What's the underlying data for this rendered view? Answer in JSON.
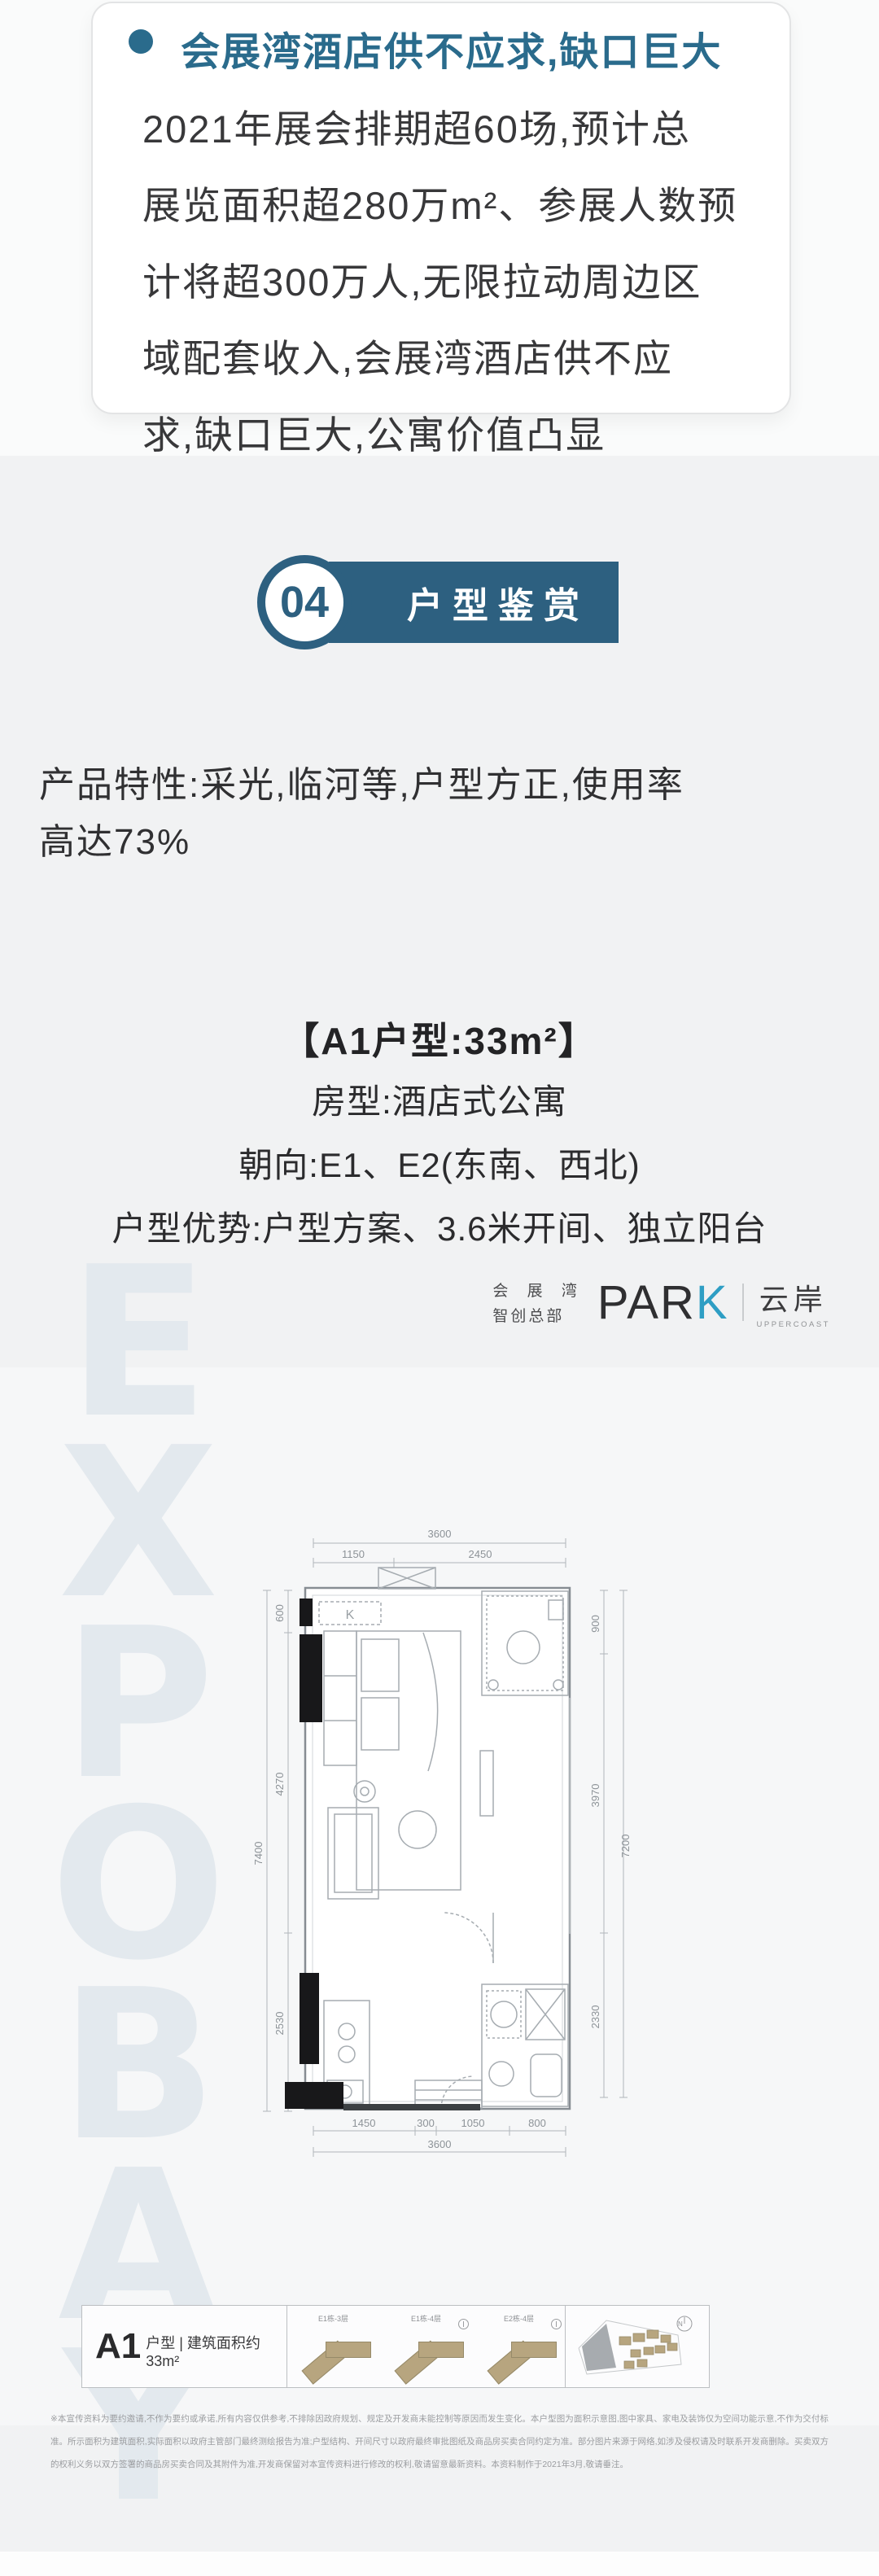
{
  "card": {
    "headline": "会展湾酒店供不应求,缺口巨大",
    "body_lines": [
      "2021年展会排期超60场,预计总",
      "展览面积超280万m²、参展人数预",
      "计将超300万人,无限拉动周边区",
      "域配套收入,会展湾酒店供不应",
      "求,缺口巨大,公寓价值凸显"
    ]
  },
  "section_badge": {
    "number": "04",
    "title": "户型鉴赏"
  },
  "features": {
    "lines": [
      "产品特性:采光,临河等,户型方正,使用率",
      "高达73%"
    ]
  },
  "unit_info": {
    "title": "【A1户型:33m²】",
    "rows": [
      "房型:酒店式公寓",
      "朝向:E1、E2(东南、西北)",
      "户型优势:户型方案、3.6米开间、独立阳台"
    ]
  },
  "logo": {
    "cn_top": "会 展 湾",
    "cn_bottom": "智创总部",
    "en_main": "PAR",
    "en_k": "K",
    "brand_cn": "云岸",
    "brand_en": "UPPERCOAST"
  },
  "watermark": {
    "text": "EXPOBAY"
  },
  "floorplan": {
    "k_label": "K",
    "dims": {
      "top_total": "3600",
      "top_segs": [
        "1150",
        "2450"
      ],
      "bottom_segs": [
        "1450",
        "300",
        "1050",
        "800"
      ],
      "bottom_total": "3600",
      "left_outer": "7400",
      "left_segs": [
        "600",
        "4270",
        "2530"
      ],
      "right_outer": "7200",
      "right_segs": [
        "900",
        "3970",
        "2330"
      ]
    }
  },
  "unit_table": {
    "name_big": "A1",
    "name_rest": "户型 | 建筑面积约33m²",
    "wings": [
      {
        "label": "E1栋-3层"
      },
      {
        "label": "E1栋-4层"
      },
      {
        "label": "E2栋-4层"
      }
    ],
    "compass": "N"
  },
  "disclaimer": {
    "text": "※本宣传资料为要约邀请,不作为要约或承诺,所有内容仅供参考,不排除因政府规划、规定及开发商未能控制等原因而发生变化。本户型图为面积示意图,图中家具、家电及装饰仅为空间功能示意,不作为交付标准。所示面积为建筑面积,实际面积以政府主管部门最终测绘报告为准;户型结构、开间尺寸以政府最终审批图纸及商品房买卖合同约定为准。部分图片来源于网络,如涉及侵权请及时联系开发商删除。买卖双方的权利义务以双方签署的商品房买卖合同及其附件为准,开发商保留对本宣传资料进行修改的权利,敬请留意最新资料。本资料制作于2021年3月,敬请垂注。"
  },
  "colors": {
    "accent": "#2a6b8c",
    "banner": "#2d6080",
    "wing_tan": "#b7a57f"
  }
}
